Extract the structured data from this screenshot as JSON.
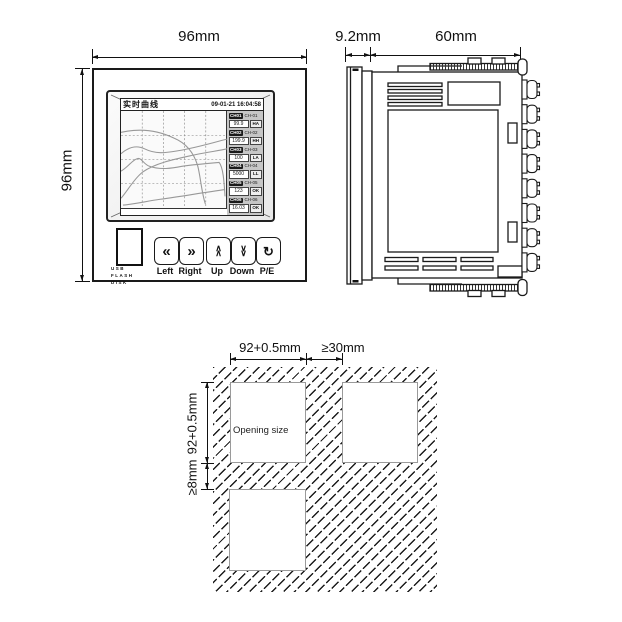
{
  "front_view": {
    "width_label": "96mm",
    "height_label": "96mm",
    "screen": {
      "title": "实时曲线",
      "timestamp": "09-01-21 16:04:58",
      "channels": [
        {
          "id": "CH01",
          "tag": "CH-01",
          "value": "99.9",
          "status": "HA"
        },
        {
          "id": "CH02",
          "tag": "CH-02",
          "value": "199.9",
          "status": "HH"
        },
        {
          "id": "CH03",
          "tag": "CH-03",
          "value": "100",
          "status": "LA"
        },
        {
          "id": "CH04",
          "tag": "CH-04",
          "value": "5000",
          "status": "LL"
        },
        {
          "id": "CH05",
          "tag": "CH-05",
          "value": "123",
          "status": "OK"
        },
        {
          "id": "CH06",
          "tag": "CH-06",
          "value": "16.03",
          "status": "OK"
        }
      ]
    },
    "usb_label": "USB\nFLASH\nDISK",
    "buttons": [
      {
        "glyph": "«",
        "label": "Left"
      },
      {
        "glyph": "»",
        "label": "Right"
      },
      {
        "glyph": "∧\n∧",
        "label": "Up"
      },
      {
        "glyph": "∨\n∨",
        "label": "Down"
      },
      {
        "glyph": "↻",
        "label": "P/E"
      }
    ]
  },
  "side_view": {
    "front_depth_label": "9.2mm",
    "body_depth_label": "60mm"
  },
  "cutout_view": {
    "opening_width_label": "92+0.5mm",
    "horizontal_gap_label": "≥30mm",
    "opening_height_label": "92+0.5mm",
    "vertical_gap_label": "≥8mm",
    "opening_text": "Opening size"
  }
}
